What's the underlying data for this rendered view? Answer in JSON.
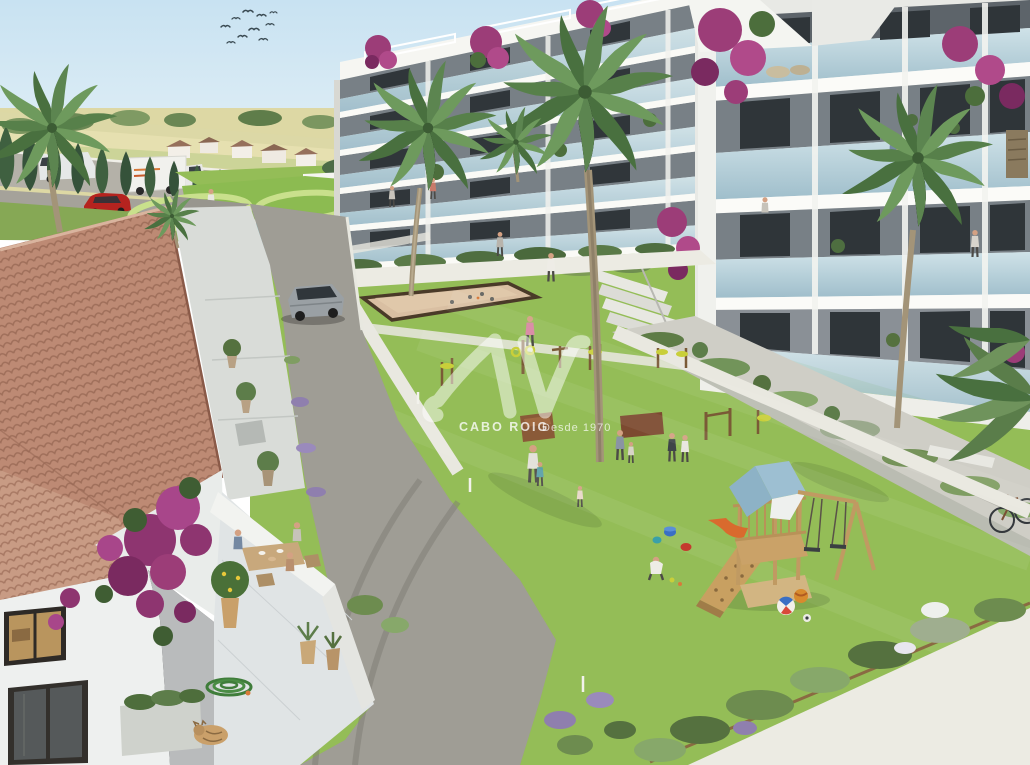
{
  "image": {
    "kind": "architectural-render",
    "view": "aerial view of a Mediterranean residential complex courtyard"
  },
  "watermark": {
    "logo_text": "AV",
    "brand": "CABO ROIG",
    "tagline": "Desde 1970",
    "color": "#ffffff"
  },
  "palette": {
    "sky": "#cfe7f4",
    "fields": "#ddd8a4",
    "grass": "#94bd57",
    "ornamental_lawn_stripe": "#c9e08c",
    "pool_water": "#7ec5d2",
    "path_white": "#ecebe3",
    "asphalt": "#98968e",
    "building_white": "#f2f2ee",
    "glass_balustrade": "#b7d0da",
    "window_dark": "#30363a",
    "roof_tile": "#bd8a74",
    "bougainvillea": "#9c3d78",
    "playground_roof": "#9dbfd2",
    "wood": "#c09a62",
    "petanque_sand": "#d9bfa2",
    "cypress": "#3f6040"
  },
  "scene": {
    "elements": [
      "sky",
      "bird-flock",
      "countryside-fields",
      "distant-treeline",
      "distant-houses",
      "distant-road",
      "white-van",
      "delivery-truck",
      "red-car",
      "cypress-hedge",
      "ornamental-lawn",
      "swimming-pool",
      "swimmers",
      "pool-deck",
      "pool-planter",
      "apartment-block-left",
      "apartment-block-right",
      "balconies",
      "glass-balustrades",
      "rooftop-pergolas",
      "bougainvillea",
      "palm-trees",
      "stairs",
      "courtyard-lawn",
      "petanque-court",
      "outdoor-gym-equipment",
      "wooden-benches",
      "residents-walking",
      "playground",
      "play-tower",
      "blue-gable-roof",
      "climbing-ramp",
      "swings",
      "slide",
      "toy-buckets",
      "beach-balls",
      "child-playing",
      "access-road",
      "suv-car",
      "mediterranean-house",
      "terracotta-roof",
      "terrace-dining",
      "potted-lemon-tree",
      "garden-hose",
      "sleeping-cat",
      "shrub-beds",
      "lavender",
      "bicycle",
      "walkways"
    ]
  }
}
